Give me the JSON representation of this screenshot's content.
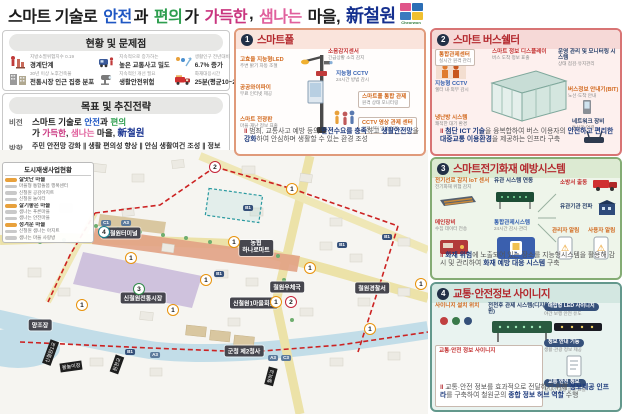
{
  "title": {
    "parts": [
      "스마트 기술로 ",
      "안전",
      "과 ",
      "편의",
      "가 ",
      "가득한",
      ", ",
      "샘나는",
      " 마을, ",
      "新철원"
    ],
    "logo": "Cheorwon"
  },
  "status": {
    "header": "현황 및 문제점",
    "items": [
      {
        "line1": "지방소멸위험지수 0.19",
        "line2": "경계단계"
      },
      {
        "line1": "지속적으로 증가하는",
        "line2": "높은 교통사고 밀도"
      },
      {
        "line1": "생활인구 전년대비",
        "line2": "6.7% 증가"
      },
      {
        "line1": "30년 이상 노후건축물",
        "line2": "전통시장 인근 집중 분포"
      },
      {
        "line1": "지속적인 개선 필요",
        "line2": "생활안전위험"
      },
      {
        "line1": "화재대응시간",
        "line2": "25분(평균10~20분)"
      }
    ]
  },
  "strategy": {
    "header": "목표 및 추진전략",
    "vision_label": "비전",
    "direction_label": "방향",
    "direction": "주민 안전망 강화 ∥ 생활 편의성 향상 ∥ 안심 생활여건 조성 ∥ 정보접근성 강화",
    "goal_label": "목표",
    "goals": [
      "실시간 모니터링으로 긴급상황 대응",
      "주민 및 방문객이 안전한 생활환경 조성",
      "대중교통 이용환경 개선으로 만족도 제고",
      "실시간 교통·안전·생활 등의 정보 접근성 개선"
    ]
  },
  "regen": {
    "header": "도시재생사업현황",
    "rows": [
      {
        "text": "살맛난 마을"
      },
      {
        "text": "마을형 통합돌봄 행복센터"
      },
      {
        "text": "신철원 공감아지트"
      },
      {
        "text": "신철원 놀이터"
      },
      {
        "text": "살기좋은 마을"
      },
      {
        "text": "샘나는 푸른마을"
      },
      {
        "text": "샘나는 안전마을"
      },
      {
        "text": "정겨운 마을"
      },
      {
        "text": "신철원 샘나는 아지트"
      },
      {
        "text": "샘나는 마을 사랑방"
      }
    ]
  },
  "map": {
    "tags": [
      "신철원터미널",
      "농협",
      "하나로마트",
      "신철원전통시장",
      "신철원1마을회관",
      "철원우체국",
      "철원경찰서",
      "군청 제2청사",
      "양조장"
    ],
    "rotated": [
      "신철원1교",
      "물놀이장",
      "원천교",
      "월하교"
    ],
    "markers": [
      "2",
      "1",
      "4",
      "1",
      "1",
      "1",
      "3",
      "1",
      "1",
      "2",
      "1",
      "1",
      "1",
      "1"
    ],
    "badges": [
      "C1",
      "A3",
      "B1",
      "B1",
      "B1",
      "B1",
      "B1",
      "A3",
      "A3",
      "C3"
    ]
  },
  "panels": [
    {
      "num": "1",
      "title": "스마트폴",
      "callouts": [
        {
          "t": "고효율 지능형LED",
          "d": "주변 밝기 자동 조절"
        },
        {
          "t": "공공와이파이",
          "d": "무료 인터넷 제공"
        },
        {
          "t": "스마트 전광판",
          "d": "마을·재난 정보 표출"
        },
        {
          "t": "소음감지센서",
          "d": "긴급상황 소리 감지"
        },
        {
          "t": "지능형 CCTV",
          "d": "24시간 방범 감시"
        },
        {
          "t": "스마트폴 통합 관제",
          "d": "원격 상태 모니터링"
        },
        {
          "t": "CCTV 영상 관제 센터",
          "d": "관제센터 영상 연계"
        }
      ],
      "caption": [
        "범죄, 교통사고 예방 등의 ",
        "안전수요를 충족",
        "하고 ",
        "생활안전망",
        "을 ",
        "강화",
        "하여 안심하며 생활할 수 있는 환경 조성"
      ]
    },
    {
      "num": "2",
      "title": "스마트 버스쉘터",
      "callouts": [
        {
          "t": "통합관제센터",
          "d": "실시간 원격 관리"
        },
        {
          "t": "지능형 CCTV",
          "d": "쉘터 내·외부 감시"
        },
        {
          "t": "냉난방 시스템",
          "d": "쾌적한 대기 환경"
        },
        {
          "t": "스마트 정보 디스플레이",
          "d": "버스 도착 정보 표출"
        },
        {
          "t": "운영 관리 및 모니터링 시스템",
          "d": "상태 점검·유지관리"
        },
        {
          "t": "버스정보 안내기(BIT)",
          "d": "노선·도착 안내"
        },
        {
          "t": "네트워크 장비",
          "d": "통신망 연결"
        }
      ],
      "caption": [
        "첨단 ICT 기술",
        "을 융복합하여 버스 이용자의 ",
        "안전하고 편리한",
        " ",
        "대중교통 이용환경",
        "을 제공하는 인프라 구축"
      ]
    },
    {
      "num": "3",
      "title": "스마트전기화재 예방시스템",
      "callouts": [
        {
          "t": "전기선로 감지 IoT 센서",
          "d": "전기화재 위험 감지"
        },
        {
          "t": "유관 시스템 연동",
          "d": ""
        },
        {
          "t": "통합관제시스템",
          "d": "24시간 감시·관리"
        },
        {
          "t": "메인장비",
          "d": "수집 데이터 전송"
        },
        {
          "t": "소방서 출동",
          "d": ""
        },
        {
          "t": "유관기관 전파",
          "d": ""
        },
        {
          "t": "관리자 알림",
          "d": ""
        },
        {
          "t": "사용자 알림",
          "d": ""
        }
      ],
      "caption": [
        "화재 위험",
        "에 노출되어 있는 장소를 지능형시스템을 활용해 감시 및 관리하여 ",
        "화재 예방 대응 시스템",
        " 구축"
      ]
    },
    {
      "num": "4",
      "title": "교통·안전정보 사이니지",
      "callouts": [
        {
          "t": "사이니지 설치 위치",
          "d": ""
        },
        {
          "t": "전천후 관제 시스템(디지털 트윈)",
          "d": ""
        },
        {
          "t": "교통·안전 정보 사이니지",
          "d": ""
        },
        {
          "t": "매립형 LED 사이니지",
          "d": "야간 보행 안전 유도"
        },
        {
          "t": "정보 안내 기능",
          "d": "생활·관광 정보 제공"
        },
        {
          "t": "교통 안전 정보",
          "d": "실시간 교통 상황 표출"
        }
      ],
      "caption": [
        "교통·안전 정보를 효과적으로 전달하기 위해 ",
        "정보제공 인프라",
        "를 구축하여 철원군의 ",
        "종합 정보 허브 역할",
        " 수행"
      ]
    }
  ]
}
